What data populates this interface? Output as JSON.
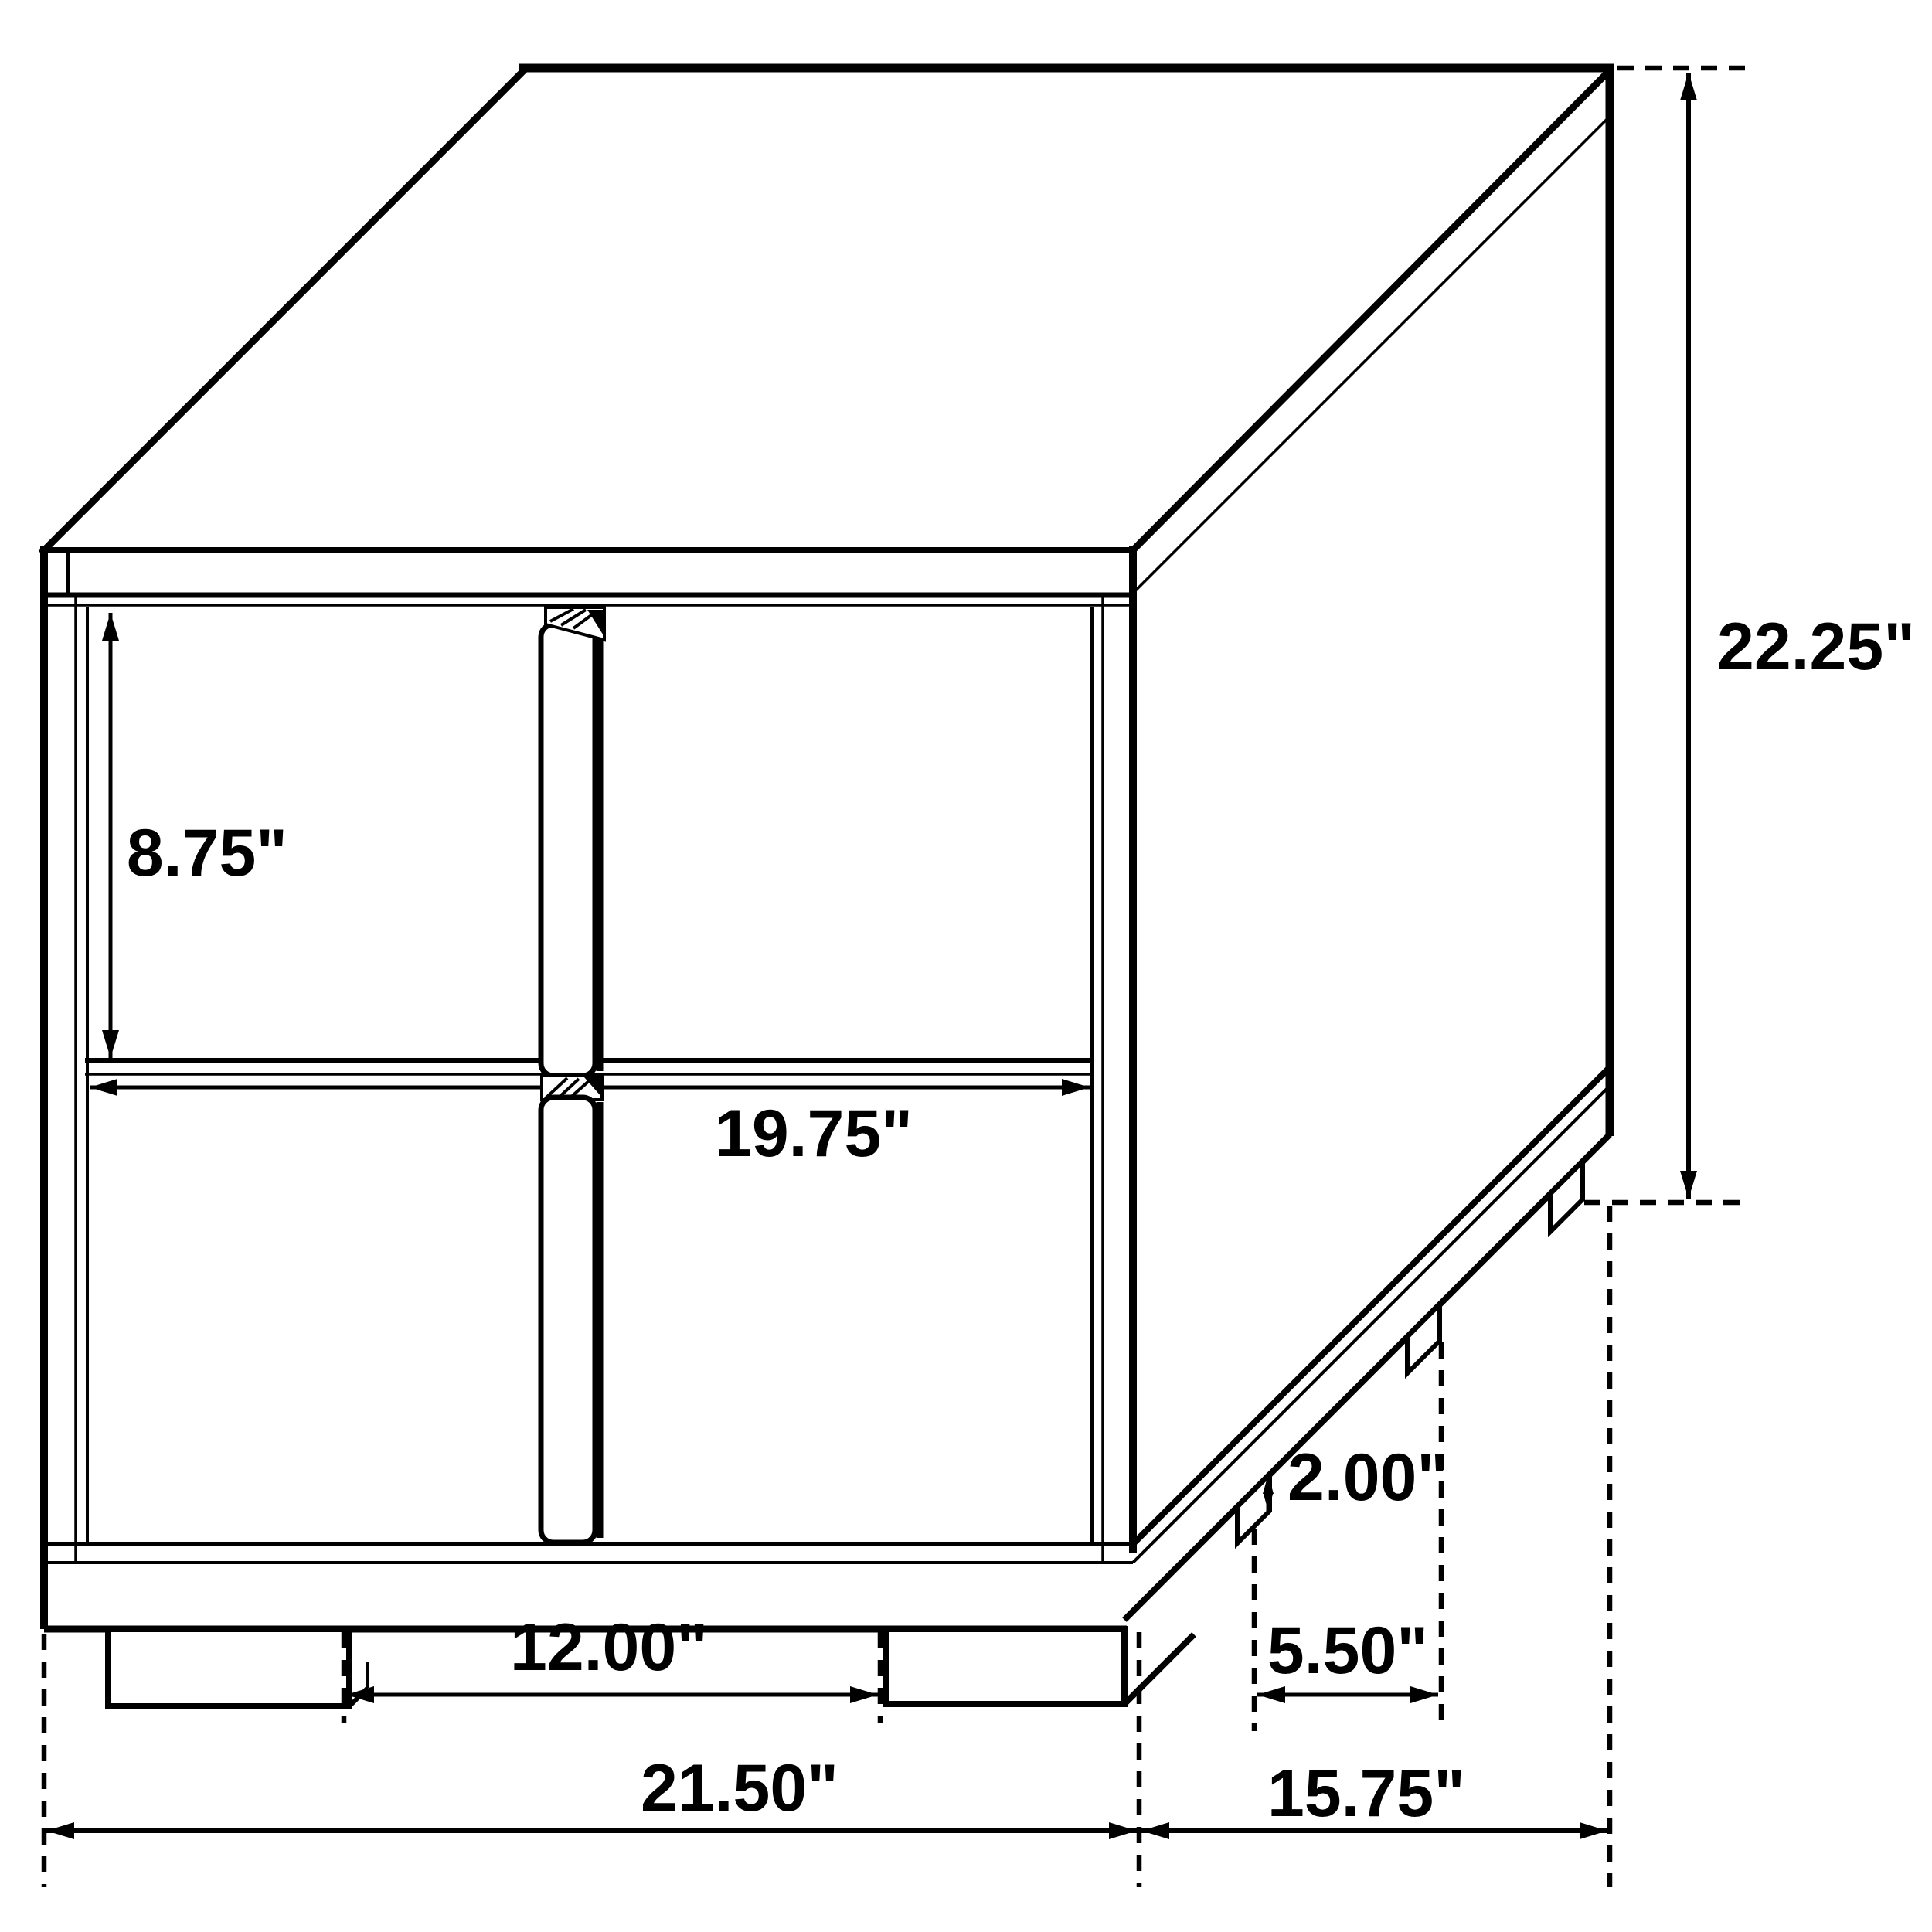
{
  "page": {
    "background_color": "#ffffff",
    "line_color": "#000000"
  },
  "drawing": {
    "kind": "furniture dimension diagram",
    "object": "two-drawer nightstand with four-panel front, center pull rails, plinth base and block feet",
    "view": "perspective line drawing",
    "units": "inches"
  },
  "dimensions": {
    "drawer_front_height": {
      "label": "8.75\""
    },
    "drawer_width": {
      "label": "19.75\""
    },
    "overall_height": {
      "label": "22.25\""
    },
    "foot_height": {
      "label": "2.00\""
    },
    "front_feet_spacing": {
      "label": "12.00\""
    },
    "side_feet_spacing": {
      "label": "5.50\""
    },
    "overall_width": {
      "label": "21.50\""
    },
    "overall_depth": {
      "label": "15.75\""
    }
  }
}
